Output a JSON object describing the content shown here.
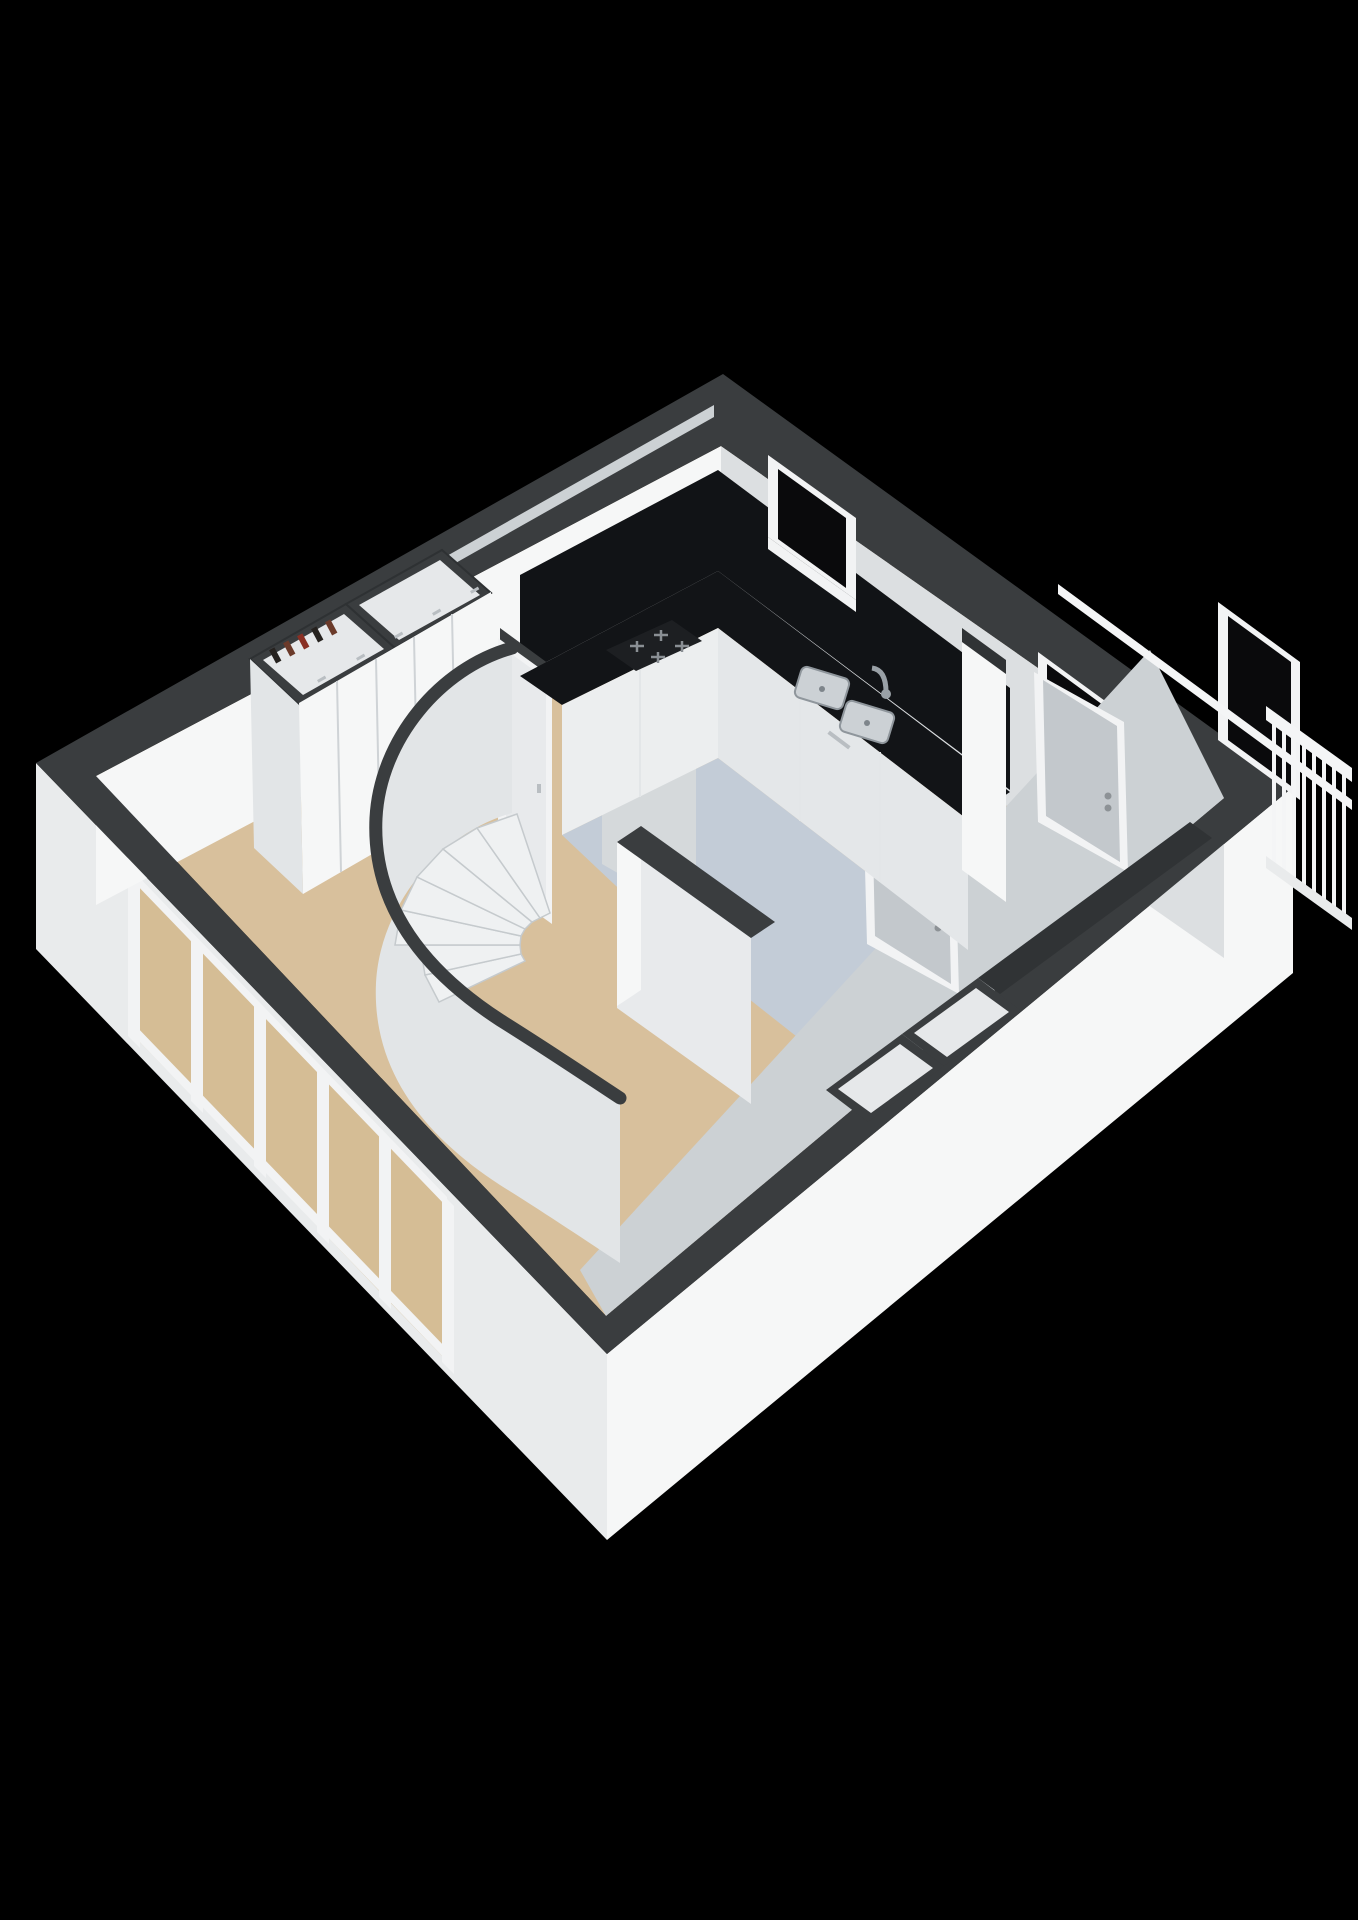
{
  "scene": {
    "kind": "isometric-3d-floor-plan-render",
    "background": "#000000",
    "rooms": [
      {
        "name": "living-area",
        "floor_color": "#d8c09c"
      },
      {
        "name": "kitchen-galley",
        "floor_color": "#c3ccd7"
      },
      {
        "name": "stairwell",
        "wall_shape": "curved"
      }
    ],
    "fixtures": {
      "staircase": {
        "type": "curved-winder",
        "visible_treads": 7
      },
      "wardrobe": {
        "doors": 5,
        "top_niches": 2,
        "niche_items": 5
      },
      "kitchen": {
        "counter_color": "#121417",
        "hob_burners": 4,
        "sink_basins": 2,
        "has_faucet": true,
        "base_cabinets": true
      },
      "windows": {
        "clerestory_slit": 1,
        "kitchen_window": 1,
        "second_window": 1
      },
      "glazed_wall_panes": 5,
      "doors": {
        "hall_door": 1,
        "interior_doors": 2,
        "balcony_door": 1
      },
      "balcony_railing_balusters": 8,
      "storage_boxes": 2
    }
  },
  "colors": {
    "background": "#000000",
    "wallCap": "#3a3d3f",
    "wallCapDark": "#303335",
    "wallWhite": "#f6f7f7",
    "wallLight": "#e9ebec",
    "wallGray": "#dcdfe1",
    "wallShadow": "#ccd1d4",
    "wallFaceSoft": "#e2e5e7",
    "wallFaceMid": "#d5d9db",
    "wallFaceDim": "#e8eaec",
    "floorMain": "#d8c09c",
    "floorKitchen": "#c3ccd7",
    "counterBlack": "#121417",
    "backsplash": "#111316",
    "applianceDark": "#1d1f22",
    "glassBlack": "#0a0a0c",
    "glassBeige": "#d5bd95",
    "frameWhite": "#f2f3f4",
    "cabinetWhite": "#eceeef",
    "cabinetShade": "#e4e7e9",
    "treadFill": "#eff1f2",
    "doorPanel": "#c3c8cc",
    "nicheInner": "#e6e8ea",
    "steel": "#b9bfc5",
    "railWhite": "#f4f5f6",
    "itemBrown": "#6b3a2a",
    "itemDark": "#26221f",
    "itemRed": "#8a2f23"
  }
}
